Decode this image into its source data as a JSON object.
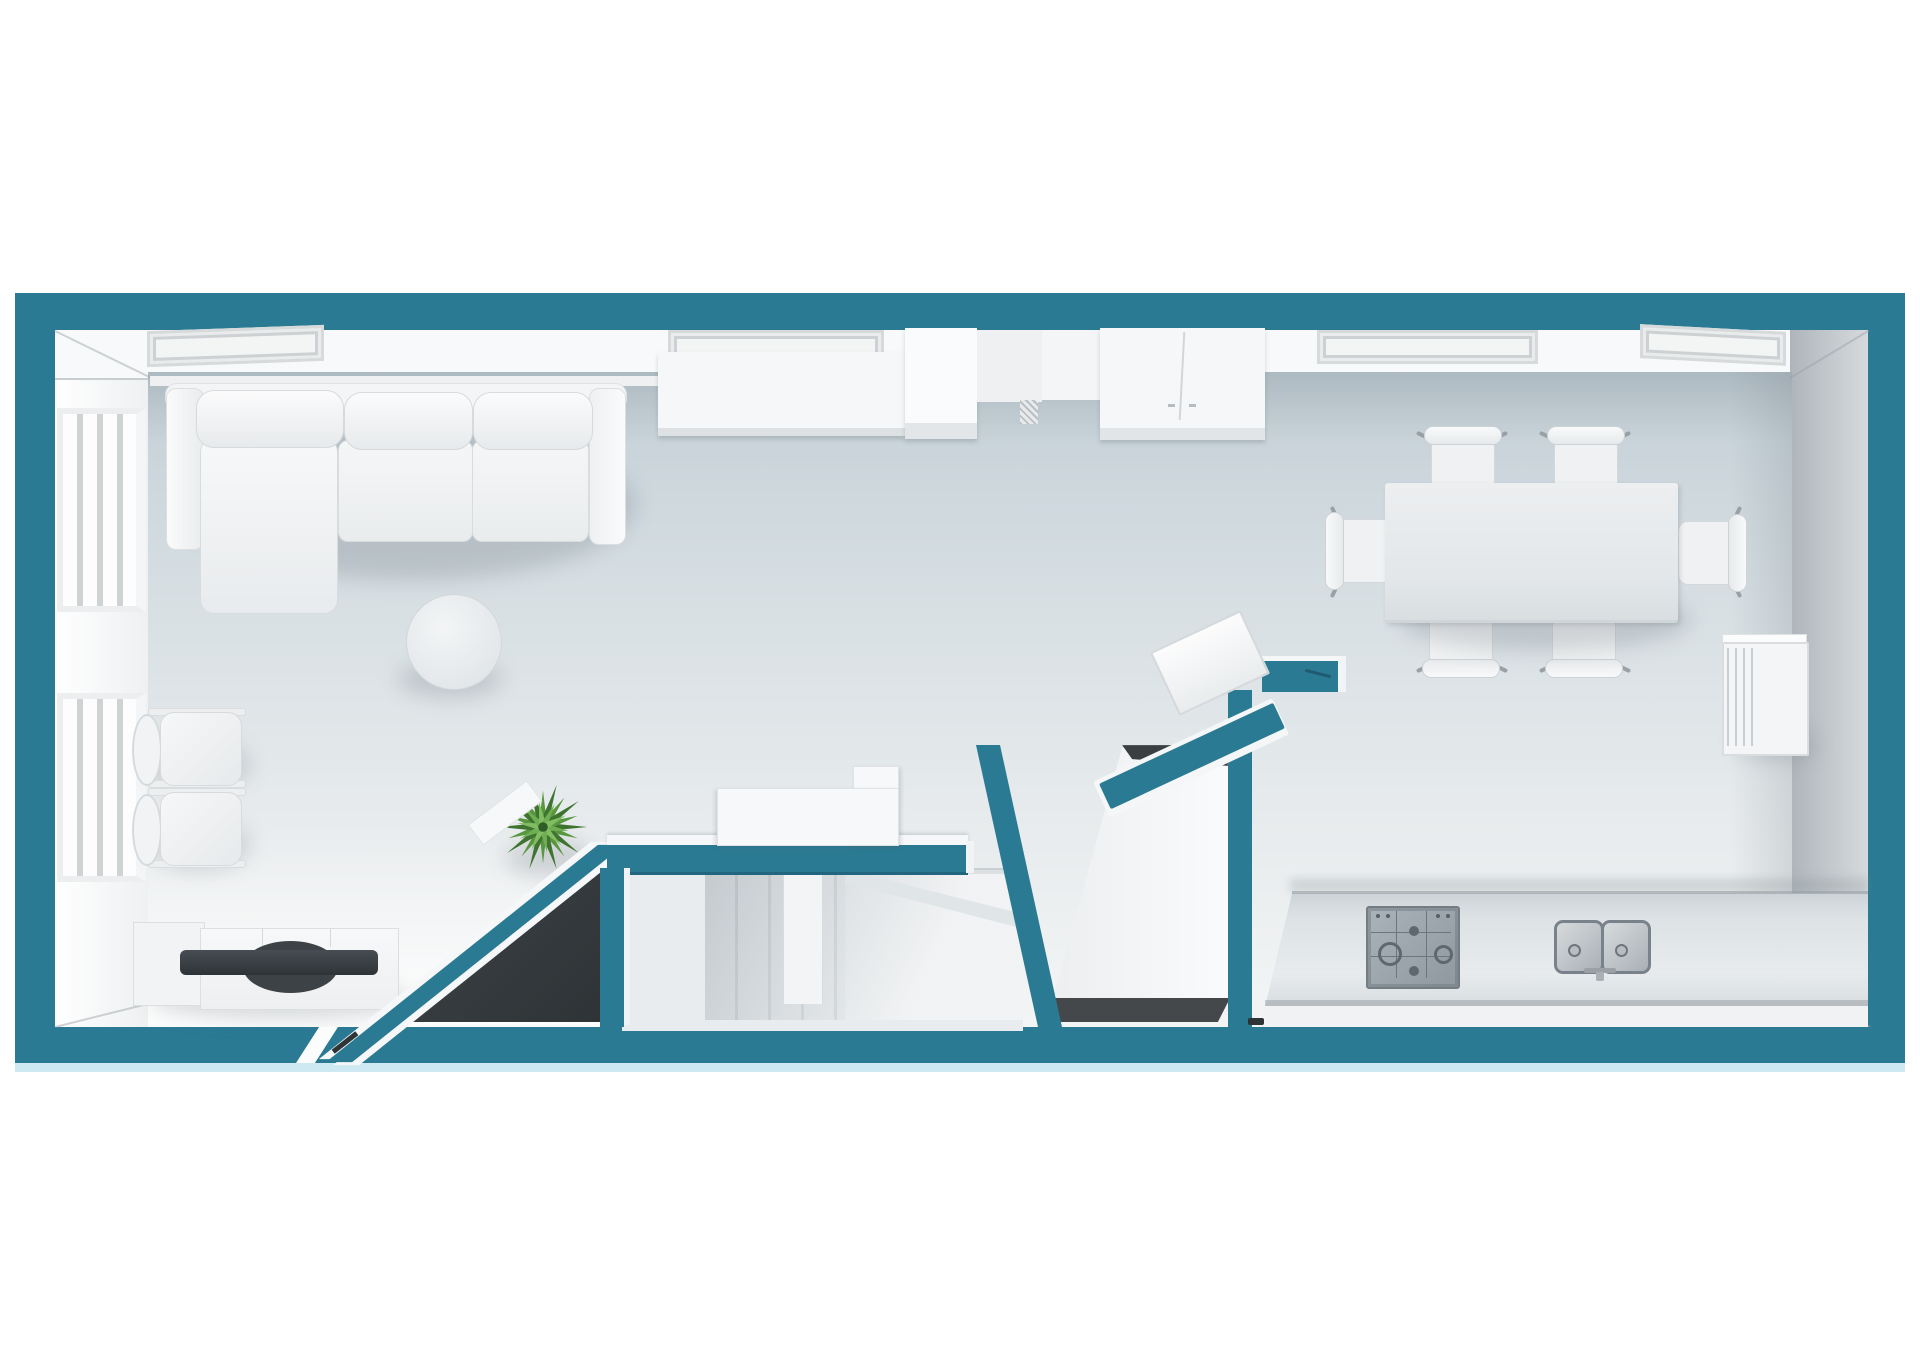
{
  "scene": {
    "kind": "3d-floor-plan-top-down-render",
    "style": "dollhouse cutaway, cut walls shown in teal, no text labels",
    "floors_shown": 1
  },
  "palette": {
    "wall_cut_teal": "#2a7a94",
    "wall_cut_teal_dark": "#20657e",
    "under_slab_blue": "#cfe9f2",
    "floor_shaded": "#c3cfd6",
    "floor_light": "#f3f5f5",
    "void_dark": "#34383b",
    "furniture_white": "#f5f6f7",
    "metal_gray": "#8f989f",
    "tv_dark": "#33383c",
    "plant_green": "#58963f",
    "background": "#ffffff"
  },
  "areas": {
    "living": {
      "label": "Living area"
    },
    "dining": {
      "label": "Dining area"
    },
    "kitchen": {
      "label": "Kitchen"
    },
    "stairs": {
      "label": "Staircase"
    },
    "closet": {
      "label": "Utility closet"
    }
  },
  "objects": {
    "sofa": {
      "label": "L-shaped sectional sofa with chaise",
      "back_cushions": 3
    },
    "coffee_table": {
      "label": "Round coffee table"
    },
    "plant": {
      "label": "Potted green plant"
    },
    "side_chairs": {
      "label": "Pair of chairs with oval backrests by left wall",
      "count": 2
    },
    "tv_console": {
      "label": "Low media sideboard with flat TV",
      "sections": 3
    },
    "windows_left_wall": {
      "label": "Windows in left wall",
      "count": 2
    },
    "window_frames_top_wall": {
      "label": "Recessed window/molding frames in top wall",
      "count": 4
    },
    "wall_cabinets": {
      "label": "Cabinet run along top wall",
      "units": 4
    },
    "stairs": {
      "label": "Straight staircase with under-stair void"
    },
    "under_stair_void": {
      "label": "Dark under-stair opening"
    },
    "stair_cabinet": {
      "label": "Notched white cabinet beside stair wall"
    },
    "desk_panel": {
      "label": "White panel/screen on angled partition wall"
    },
    "closet_unit": {
      "label": "Tall white unit (fridge/wardrobe) inside closet"
    },
    "door_threshold": {
      "label": "Dark threshold dash at closet doorway"
    },
    "kitchen_counter": {
      "label": "Straight kitchen counter along bottom wall"
    },
    "hob": {
      "label": "4-burner gas hob",
      "burners": 4,
      "knobs": 4
    },
    "sink": {
      "label": "Double-bowl sink with faucet",
      "bowls": 2
    },
    "dining_table": {
      "label": "Rectangular dining table",
      "chairs": 6
    },
    "right_wall_cabinet": {
      "label": "Small sideboard on right wall"
    }
  }
}
